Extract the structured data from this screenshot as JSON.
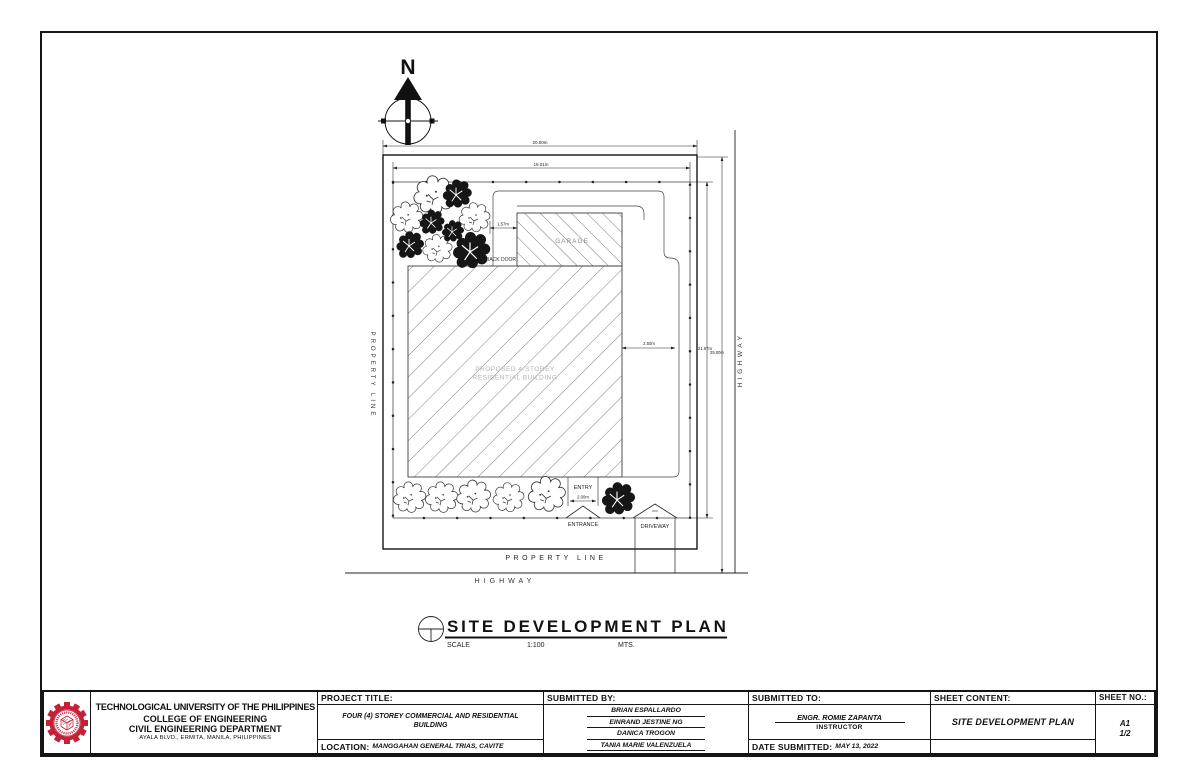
{
  "plan": {
    "north_label": "N",
    "dim_top_outer": "20.00m",
    "dim_top_inner": "19.01m",
    "dim_right_inner": "21.57m",
    "dim_right_outer": "25.00m",
    "dim_garage_offset": "1.57m",
    "dim_building_right": "2.50m",
    "dim_entry_width": "2.00m",
    "label_garage": "GARAGE",
    "label_back_door": "BACK DOOR",
    "label_building_line1": "PROPOSED 4-STOREY",
    "label_building_line2": "RESIDENTIAL BUILDING",
    "label_entry": "ENTRY",
    "label_entrance": "ENTRANCE",
    "label_driveway": "DRIVEWAY",
    "label_property_line_left": "PROPERTY LINE",
    "label_property_line_bottom": "PROPERTY LINE",
    "label_highway_right": "HIGHWAY",
    "label_highway_bottom": "HIGHWAY"
  },
  "plan_title": {
    "title": "SITE DEVELOPMENT PLAN",
    "scale_label": "SCALE",
    "scale_value": "1:100",
    "units": "MTS."
  },
  "title_block": {
    "university": "TECHNOLOGICAL UNIVERSITY OF THE PHILIPPINES",
    "college": "COLLEGE OF ENGINEERING",
    "department": "CIVIL ENGINEERING DEPARTMENT",
    "address": "AYALA BLVD., ERMITA, MANILA, PHILIPPINES",
    "project_title_label": "PROJECT TITLE:",
    "project_title": "FOUR (4) STOREY COMMERCIAL AND RESIDENTIAL BUILDING",
    "location_label": "LOCATION:",
    "location": "MANGGAHAN GENERAL TRIAS, CAVITE",
    "submitted_by_label": "SUBMITTED BY:",
    "submitted_by": [
      "BRIAN ESPALLARDO",
      "EINRAND JESTINE NG",
      "DANICA TROGON",
      "TANIA MARIE VALENZUELA"
    ],
    "submitted_to_label": "SUBMITTED TO:",
    "submitted_to_name": "ENGR. ROMIE ZAPANTA",
    "submitted_to_role": "INSTRUCTOR",
    "date_label": "DATE SUBMITTED:",
    "date_value": "MAY 13, 2022",
    "sheet_content_label": "SHEET CONTENT:",
    "sheet_content": "SITE DEVELOPMENT PLAN",
    "sheet_no_label": "SHEET NO.:",
    "sheet_no_line1": "A1",
    "sheet_no_line2": "1/2"
  },
  "colors": {
    "accent_red": "#c4203a",
    "line": "#1a1a1a"
  }
}
